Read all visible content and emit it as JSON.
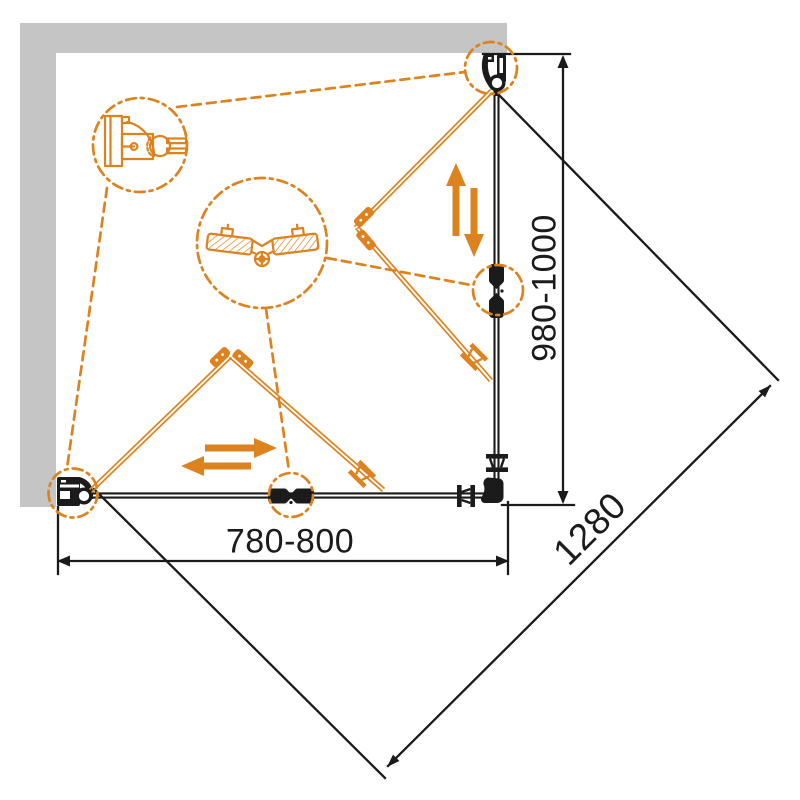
{
  "title": "Corner shower enclosure dimensional drawing",
  "colors": {
    "accent": "#DC821E",
    "ink": "#1B1B1B",
    "wall": "#C5C5C6",
    "background": "#FFFFFF"
  },
  "dimensions": {
    "width": {
      "label": "780-800"
    },
    "depth": {
      "label": "980-1000"
    },
    "diagonal": {
      "label": "1280"
    }
  },
  "icons": [
    "wall-profile-detail",
    "glass-clamp-detail",
    "top-roller-hinge",
    "bottom-roller-hinge",
    "center-glass-connector",
    "wall-mount-bracket",
    "corner-elbow-connector",
    "floor-bracket-spool",
    "glass-clamp-spool",
    "slide-direction-arrows"
  ]
}
